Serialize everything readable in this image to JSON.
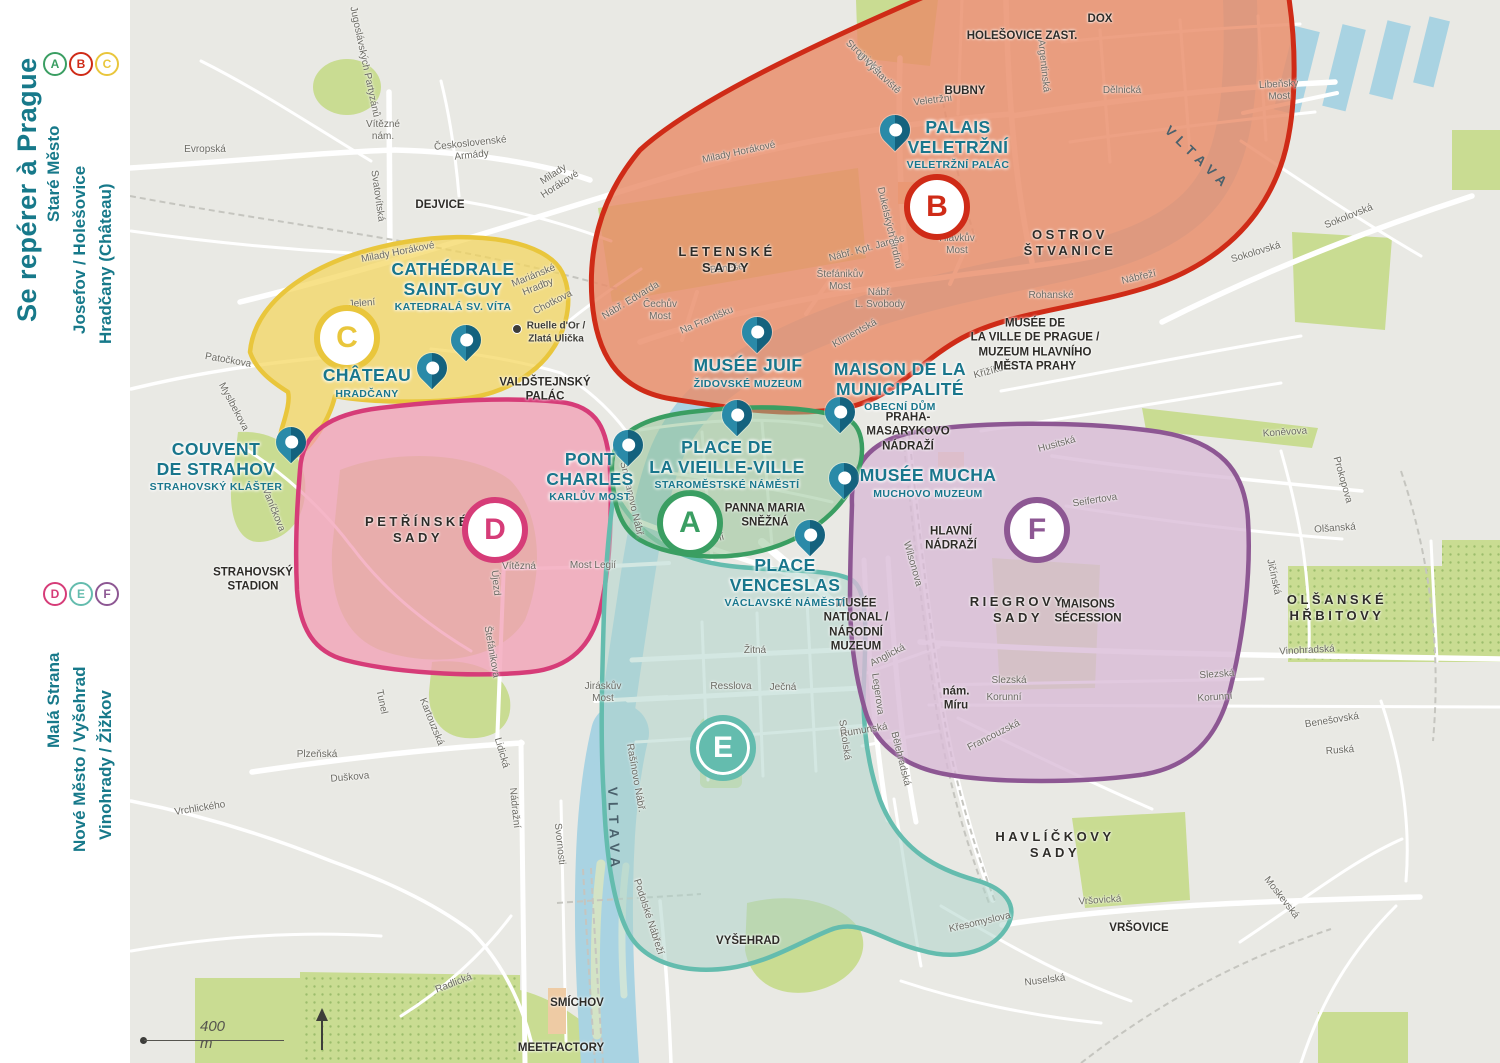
{
  "colors": {
    "background": "#e9e9e4",
    "road": "#ffffff",
    "water": "#a9d3e2",
    "island": "#d3e3c6",
    "park": "#c9dc92",
    "parkdot": "#9cbd6c",
    "rail": "#c5c5bf",
    "building": "#eecba4",
    "poi": "#19768c",
    "ink": "#2e2c28",
    "street": "#6b6a63",
    "water_ink": "#4a616c",
    "accent": "#17798a",
    "pin": "#2a8aa8",
    "pin_dark": "#14627e"
  },
  "zones": {
    "A": {
      "letter": "A",
      "stroke": "#3a9e62",
      "fill": "rgba(150,195,150,0.55)"
    },
    "B": {
      "letter": "B",
      "stroke": "#cf2b17",
      "fill": "rgba(233,140,105,0.82)"
    },
    "C": {
      "letter": "C",
      "stroke": "#e9c63c",
      "fill": "rgba(244,213,92,0.72)"
    },
    "D": {
      "letter": "D",
      "stroke": "#d63c78",
      "fill": "rgba(241,158,180,0.75)"
    },
    "E": {
      "letter": "E",
      "stroke": "#64bcae",
      "fill": "rgba(175,212,202,0.55)"
    },
    "F": {
      "letter": "F",
      "stroke": "#8d5793",
      "fill": "rgba(216,186,214,0.78)"
    }
  },
  "sidebar": {
    "title": "Se repérer à Prague",
    "groups": [
      {
        "items": [
          {
            "letter": "A",
            "label": "Staré Město"
          },
          {
            "letter": "B",
            "label": "Josefov / Holešovice"
          },
          {
            "letter": "C",
            "label": "Hradčany (Château)"
          }
        ]
      },
      {
        "items": [
          {
            "letter": "D",
            "label": "Malá Strana"
          },
          {
            "letter": "E",
            "label": "Nové Město / Vyšehrad"
          },
          {
            "letter": "F",
            "label": "Vinohrady / Žižkov"
          }
        ]
      }
    ]
  },
  "pois": [
    {
      "name": "PALAIS\nVELETRŽNÍ",
      "sub": "VELETRŽNÍ PALÁC"
    },
    {
      "name": "MUSÉE JUIF",
      "sub": "ŽIDOVSKÉ MUZEUM"
    },
    {
      "name": "MAISON DE LA\nMUNICIPALITÉ",
      "sub": "OBECNÍ DŮM"
    },
    {
      "name": "CATHÉDRALE\nSAINT-GUY",
      "sub": "KATEDRALÁ SV. VÍTA"
    },
    {
      "name": "CHÂTEAU",
      "sub": "HRADČANY"
    },
    {
      "name": "COUVENT\nDE STRAHOV",
      "sub": "STRAHOVSKÝ KLÁŠTER"
    },
    {
      "name": "PONT\nCHARLES",
      "sub": "KARLŮV MOST"
    },
    {
      "name": "PLACE DE\nLA VIEILLE-VILLE",
      "sub": "STAROMĚSTSKÉ NÁMĚSTÍ"
    },
    {
      "name": "PLACE\nVENCESLAS",
      "sub": "VÁCLAVSKÉ NÁMĚSTÍ"
    },
    {
      "name": "MUSÉE MUCHA",
      "sub": "MUCHOVO MUZEUM"
    }
  ],
  "places": [
    "DOX",
    "HOLEŠOVICE ZAST.",
    "BUBNY",
    "OSTROV\nŠTVANICE",
    "LETENSKÉ\nSADY",
    "PETŘÍNSKÉ\nSADY",
    "RIEGROVY\nSADY",
    "MAISONS\nSÉCESSION",
    "HAVLÍČKOVY\nSADY",
    "OLŠANSKÉ\nHŘBITOVY",
    "STRAHOVSKÝ\nSTADION",
    "DEJVICE",
    "SMÍCHOV",
    "MEETFACTORY",
    "VYŠEHRAD",
    "VRŠOVICE",
    "VALDŠTEJNSKÝ\nPALÁC",
    "PRAHA-\nMASARYKOVO\nNÁDRAŽÍ",
    "HLAVNÍ\nNÁDRAŽÍ",
    "PANNA MARIA\nSNĚŽNÁ",
    "MUSÉE\nNATIONAL /\nNÁRODNÍ\nMUZEUM",
    "MUSÉE DE\nLA VILLE DE PRAGUE /\nMUZEUM HLAVNÍHO\nMĚSTA PRAHY",
    "nám.\nMíru",
    "Ruelle d'Or /\nZlatá Ulička"
  ],
  "streets": [
    "Evropská",
    "Vítězné\nnám.",
    "Československé\nArmády",
    "Svatovítská",
    "Jugoslávských Partyzánů",
    "Milady Horákové",
    "Milady\nHorákové",
    "Milady Horákové",
    "Patočkova",
    "Myslbekova",
    "Jelení",
    "Mariánské\nHradby",
    "Chotkova",
    "Vaníčkova",
    "Strojnická",
    "U Výstaviště",
    "Veletržní",
    "Argentinská",
    "Dělnická",
    "Sokolovská",
    "Sokolovská",
    "Nábřeží",
    "Rohanské",
    "Křižíkova",
    "Na Františku",
    "Nábř. Edvarda",
    "Beneše",
    "Klimentská",
    "Dukelských Hrdinů",
    "Nábř. Kpt. Jaroše",
    "Smetanovo Nábř.",
    "Národní",
    "Most Legií",
    "Vítězná",
    "Újezd",
    "Štefánikova",
    "Žitná",
    "Resslova",
    "Ječná",
    "Rašínovo Nábř.",
    "Podolské Nábřeží",
    "Sokolská",
    "Legerova",
    "Wilsonova",
    "Anglická",
    "Rumunská",
    "Bělehradská",
    "Francouzská",
    "Slezská",
    "Korunní",
    "Slezská",
    "Korunní",
    "Husitská",
    "Seifertova",
    "Koněvova",
    "Prokopova",
    "Olšanská",
    "Jičínská",
    "Vinohradská",
    "Benešovská",
    "Ruská",
    "Vršovická",
    "Moskevská",
    "Křesomyslova",
    "Nuselská",
    "Vrchlického",
    "Plzeňská",
    "Duškova",
    "Kartouzská",
    "Lidická",
    "Nádražní",
    "Svornosti",
    "Radlická",
    "Tunel",
    "Hlávkův\nMost",
    "Štefánikův\nMost",
    "Čechův\nMost",
    "Nábř.\nL. Svobody",
    "Libeňský\nMost",
    "Jiráskův\nMost"
  ],
  "water_labels": [
    "VLTAVA",
    "VLTAVA"
  ],
  "scale": {
    "label": "400 m"
  }
}
